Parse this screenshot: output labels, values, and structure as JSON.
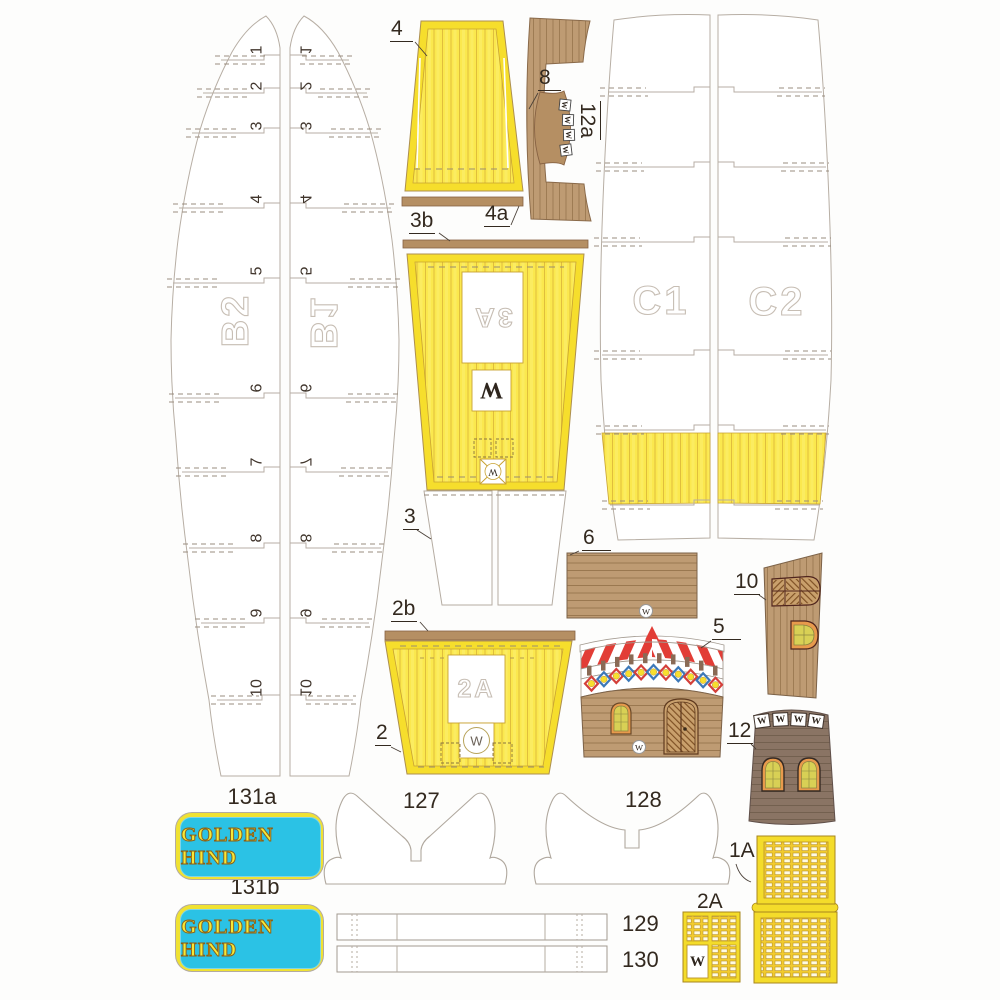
{
  "palette": {
    "deck_yellow": "#FBE84E",
    "deck_border_yellow": "#F6DE2C",
    "wood_tan": "#BE9B73",
    "wood_dark": "#8A7464",
    "plate_cyan": "#2BC2E5",
    "plate_yellow": "#F0E232",
    "awning_red": "#E23D36",
    "diamond_blue": "#3C78B8",
    "window_orange": "#E89A4C",
    "pane_green": "#D8D055"
  },
  "hulls": {
    "b2": {
      "label": "B2",
      "numbers": [
        "1",
        "2",
        "3",
        "4",
        "5",
        "6",
        "7",
        "8",
        "9",
        "10"
      ]
    },
    "b1": {
      "label": "B1",
      "numbers": [
        "1",
        "2",
        "3",
        "4",
        "5",
        "6",
        "7",
        "8",
        "9",
        "10"
      ]
    },
    "c1": {
      "label": "C1"
    },
    "c2": {
      "label": "C2"
    }
  },
  "labels": {
    "p4": "4",
    "p8": "8",
    "p12a": "12a",
    "p4a": "4a",
    "p3b": "3b",
    "p3": "3",
    "p6": "6",
    "p10": "10",
    "p5": "5",
    "p2b": "2b",
    "p2": "2",
    "p12": "12",
    "p127": "127",
    "p128": "128",
    "p129": "129",
    "p130": "130",
    "p131a": "131a",
    "p131b": "131b",
    "p1a": "1A",
    "p2a": "2A"
  },
  "marks": {
    "deck3a_hole": "3A",
    "deck3a_w": "W",
    "deck3a_xbox_w": "W",
    "deck2a_hole": "2A",
    "deck2a_w": "W",
    "p6_w": "W",
    "p5_w": "W",
    "grate2a_w": "W",
    "p12a_windows": [
      "W",
      "W",
      "W",
      "W"
    ],
    "tower_windows": [
      "W",
      "W",
      "W",
      "W"
    ]
  },
  "plates": {
    "text_a": "GOLDEN HIND",
    "text_b": "GOLDEN HIND"
  }
}
